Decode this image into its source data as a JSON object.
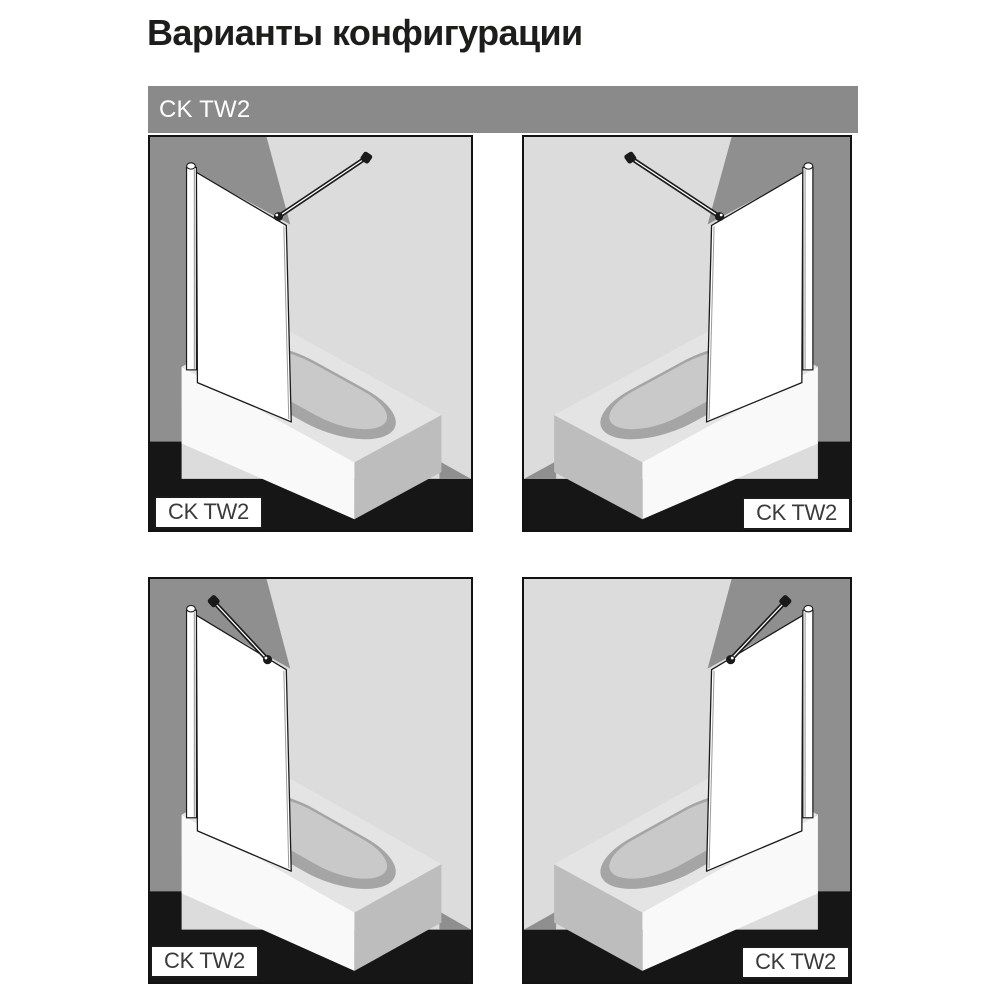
{
  "page": {
    "title": "Варианты конфигурации"
  },
  "header": {
    "label": "CK TW2"
  },
  "panels": [
    {
      "id": "top-left",
      "label": "CK TW2",
      "orientation": "screen-left",
      "support_bar": "perpendicular-to-side-wall",
      "label_position": "bottom-left"
    },
    {
      "id": "top-right",
      "label": "CK TW2",
      "orientation": "screen-right",
      "support_bar": "perpendicular-to-side-wall",
      "label_position": "bottom-right"
    },
    {
      "id": "bottom-left",
      "label": "CK TW2",
      "orientation": "screen-left",
      "support_bar": "angled-45-to-back-wall",
      "label_position": "bottom-left"
    },
    {
      "id": "bottom-right",
      "label": "CK TW2",
      "orientation": "screen-right",
      "support_bar": "angled-45-to-back-wall",
      "label_position": "bottom-right"
    }
  ],
  "colors": {
    "page-bg": "#ffffff",
    "title-text": "#1d1d1b",
    "header-bg": "#8a8a8a",
    "header-text": "#ffffff",
    "panel-frame": "#121212",
    "wall-light": "#dcdcdc",
    "wall-dark": "#8f8f8f",
    "floor-dark": "#161616",
    "tub-front": "#f9f9f9",
    "tub-top": "#e4e4e4",
    "tub-end": "#bdbdbd",
    "basin-ring": "#a5a5a5",
    "basin-floor": "#c9c9c9",
    "line-dark": "#1a1a1a",
    "label-bg": "#ffffff",
    "label-text": "#3a3a3a"
  }
}
